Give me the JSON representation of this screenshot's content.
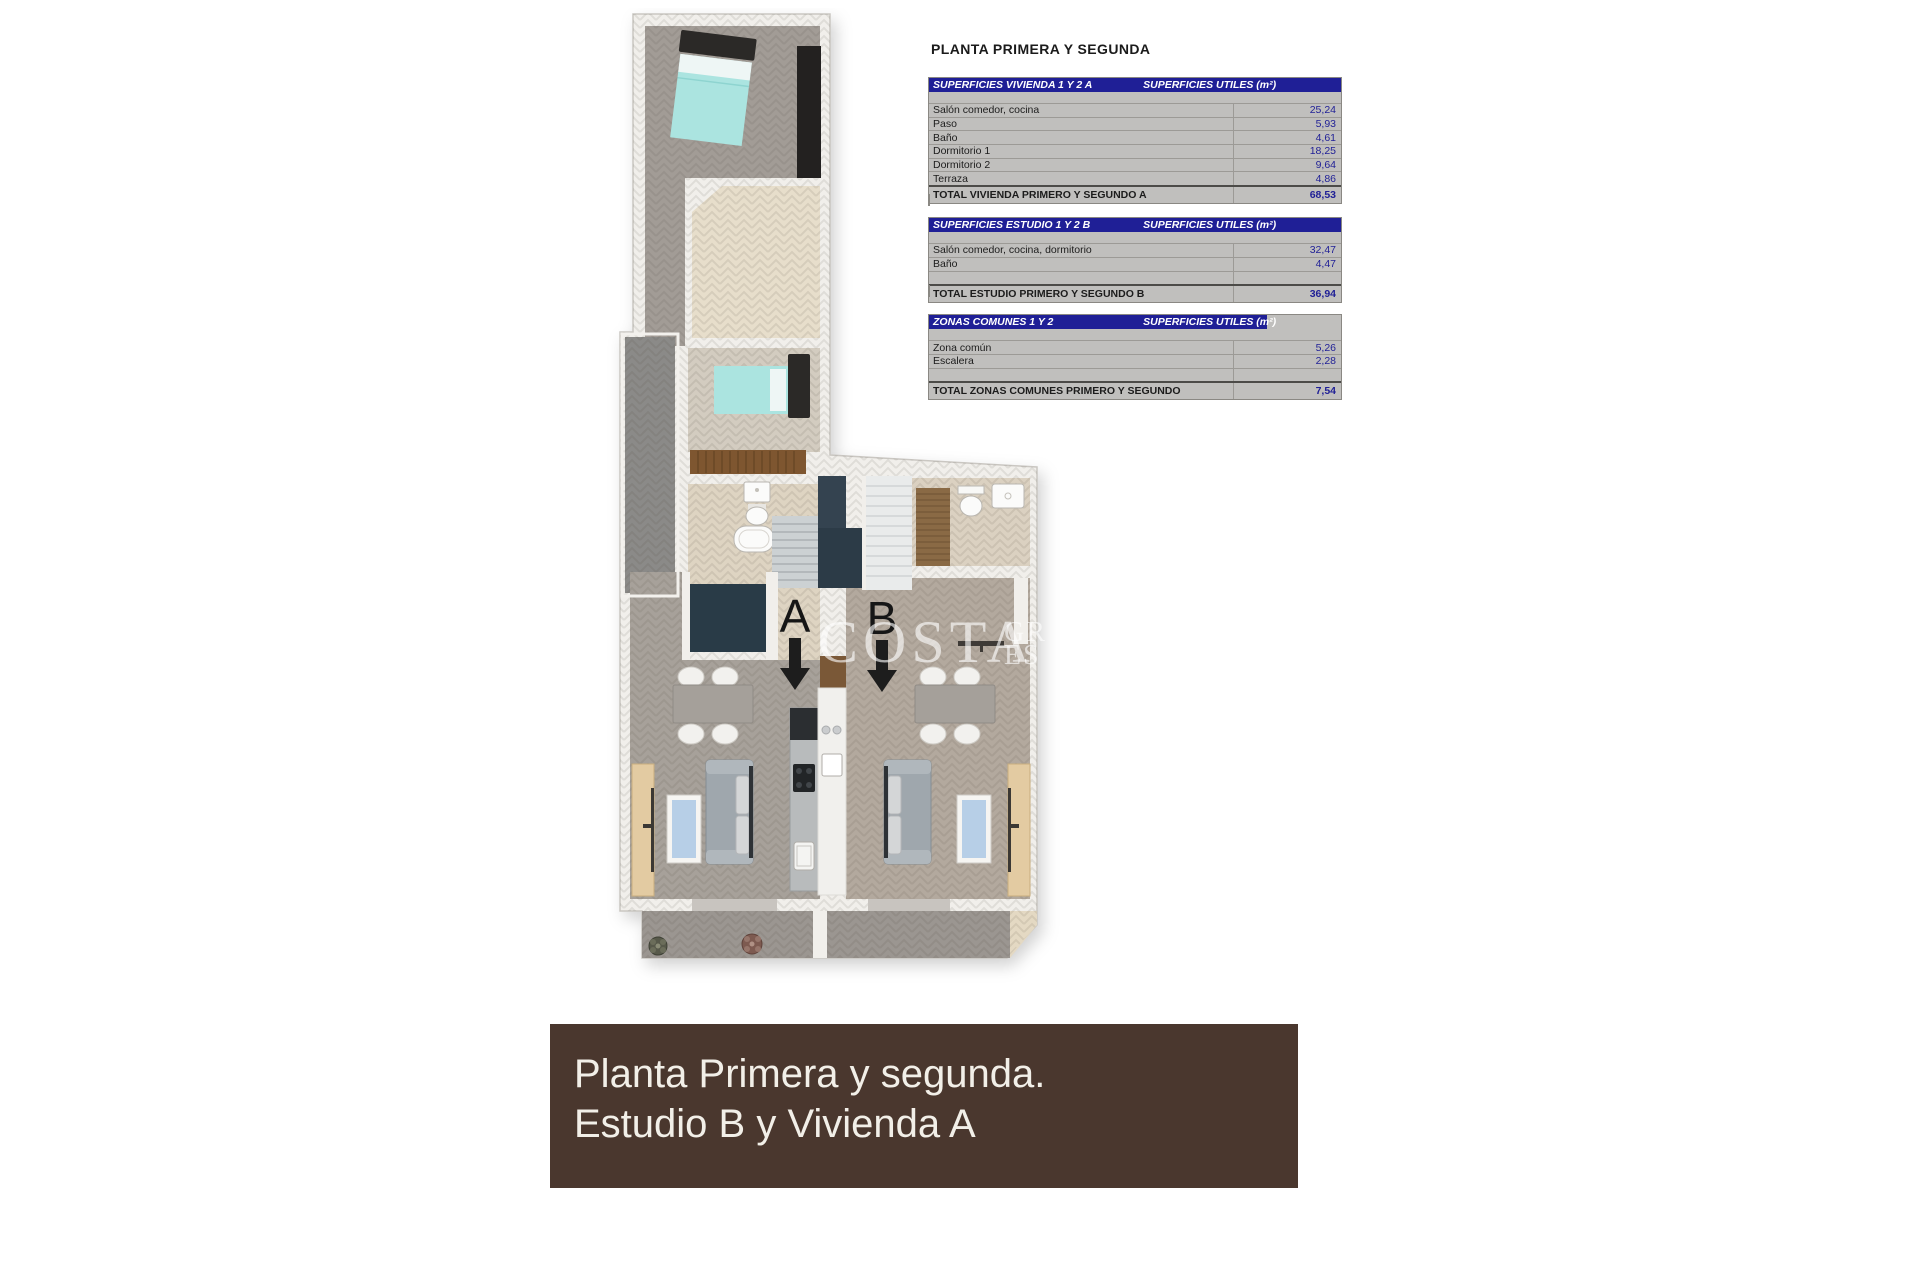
{
  "title": "PLANTA PRIMERA Y SEGUNDA",
  "table": {
    "value_header": "SUPERFICIES UTILES  (m²)",
    "sections": [
      {
        "header": "SUPERFICIES VIVIENDA 1 Y 2 A",
        "rows": [
          {
            "label": "Salón comedor, cocina",
            "value": "25,24"
          },
          {
            "label": "Paso",
            "value": "5,93"
          },
          {
            "label": "Baño",
            "value": "4,61"
          },
          {
            "label": "Dormitorio 1",
            "value": "18,25"
          },
          {
            "label": "Dormitorio 2",
            "value": "9,64"
          },
          {
            "label": "Terraza",
            "value": "4,86"
          }
        ],
        "total": {
          "label": "TOTAL VIVIENDA PRIMERO Y SEGUNDO A",
          "value": "68,53"
        }
      },
      {
        "header": "SUPERFICIES ESTUDIO 1 Y 2 B",
        "rows": [
          {
            "label": "Salón comedor, cocina, dormitorio",
            "value": "32,47"
          },
          {
            "label": "Baño",
            "value": "4,47"
          }
        ],
        "total": {
          "label": "TOTAL ESTUDIO PRIMERO Y SEGUNDO B",
          "value": "36,94"
        }
      },
      {
        "header": "ZONAS COMUNES 1 Y 2",
        "rows": [
          {
            "label": "Zona común",
            "value": "5,26"
          },
          {
            "label": "Escalera",
            "value": "2,28"
          }
        ],
        "total": {
          "label": "TOTAL ZONAS COMUNES PRIMERO Y SEGUNDO",
          "value": "7,54"
        }
      }
    ]
  },
  "plan": {
    "unit_label_a": "A",
    "unit_label_b": "B",
    "watermark_main": "COSTA",
    "watermark_top": "GR",
    "watermark_bottom": "ES"
  },
  "banner": {
    "line1": "Planta Primera y segunda.",
    "line2": "Estudio B y Vivienda A"
  },
  "colors": {
    "table_header_bg": "#1f1f96",
    "table_row_bg": "#c0bfbd",
    "table_value_text": "#1f1f96",
    "banner_bg": "#4a372e",
    "banner_text": "#f2efe8",
    "bed_teal": "#abe4e0",
    "floor_gray": "#a7a19a",
    "floor_beige": "#d3ccc0",
    "window_blue": "#b7cfe7",
    "wood_brown": "#7e5630",
    "stair_navy": "#2c3b47"
  }
}
